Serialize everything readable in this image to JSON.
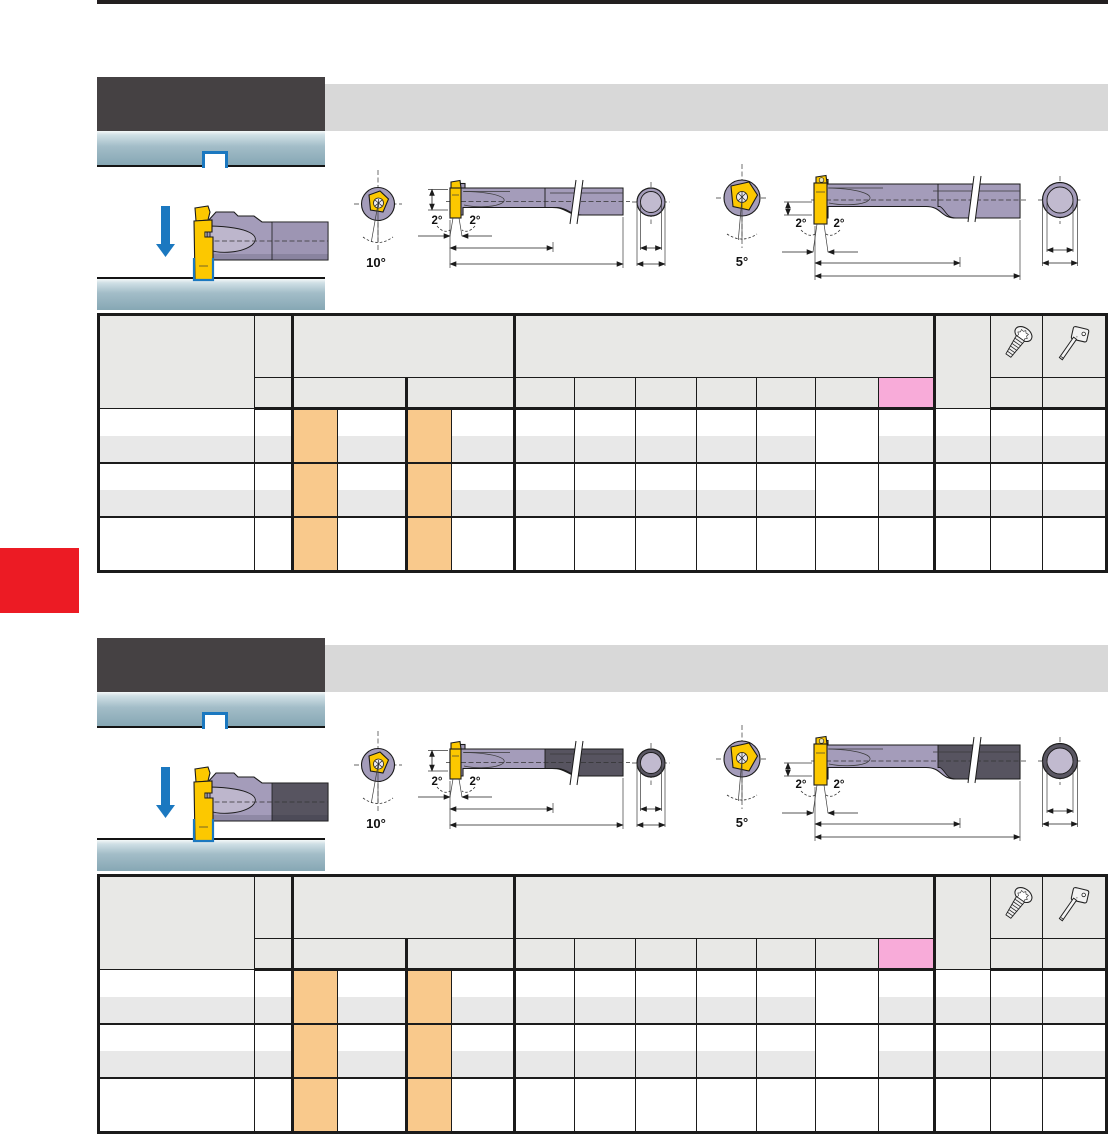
{
  "page": {
    "side_tab_color": "#ec1b24",
    "top_rule_color": "#231f20"
  },
  "colors": {
    "section_header_bar": "#454143",
    "section_header_band": "#d8d8d8",
    "teal_bar_top": "#cfdfe5",
    "teal_bar_bottom": "#86a7b4",
    "accent_blue": "#1b78c0",
    "insert_yellow": "#fcc800",
    "tool_body_purple": "#a49cba",
    "tool_body_dark": "#575460",
    "table_orange_highlight": "#f9c98c",
    "table_pink_highlight": "#f8abd9",
    "table_row_stripe": "#e8e8e8",
    "table_header_cell": "#e8e8e6"
  },
  "sections": [
    {
      "diagram_left": {
        "front_angle": "10°",
        "taper_left": "2°",
        "taper_right": "2°"
      },
      "diagram_right": {
        "front_angle": "5°",
        "taper_left": "2°",
        "taper_right": "2°"
      },
      "table": {
        "header_icons": [
          "torx-screw",
          "torx-key"
        ],
        "body_rows": 5
      }
    },
    {
      "diagram_left": {
        "front_angle": "10°",
        "taper_left": "2°",
        "taper_right": "2°"
      },
      "diagram_right": {
        "front_angle": "5°",
        "taper_left": "2°",
        "taper_right": "2°"
      },
      "table": {
        "header_icons": [
          "torx-screw",
          "torx-key"
        ],
        "body_rows": 5
      }
    }
  ]
}
